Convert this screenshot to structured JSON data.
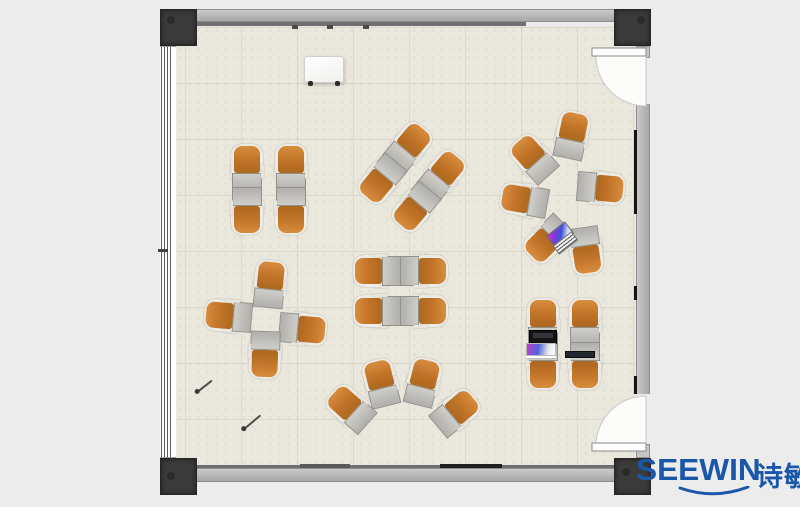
{
  "scene_title": "Classroom floor plan with desk-chair clusters",
  "logo": {
    "brand": "SEEWIN",
    "chinese": "诗敏",
    "color": "#1b57a8"
  },
  "colors": {
    "background": "#ececec",
    "floor": "#eae7dd",
    "floor_grid": "#dcd8cb",
    "wall": "#b5b5b5",
    "wall_dark_line": "#6f6f6f",
    "corner_post": "#3b3b3b",
    "chair_orange": "#c07327",
    "chair_frame": "#ecebe5",
    "desk_gray": "#b8b7b3",
    "door_swing": "#fcfcfa"
  },
  "plan": {
    "units": [
      {
        "x": 247,
        "y": 168,
        "r": 0
      },
      {
        "x": 291,
        "y": 168,
        "r": 0
      },
      {
        "x": 247,
        "y": 211,
        "r": 180
      },
      {
        "x": 291,
        "y": 211,
        "r": 180
      },
      {
        "x": 409,
        "y": 146,
        "r": 40
      },
      {
        "x": 443,
        "y": 174,
        "r": 40
      },
      {
        "x": 381,
        "y": 180,
        "r": 220
      },
      {
        "x": 415,
        "y": 208,
        "r": 220
      },
      {
        "x": 572,
        "y": 135,
        "r": 12
      },
      {
        "x": 533,
        "y": 158,
        "r": -42
      },
      {
        "x": 524,
        "y": 200,
        "r": -80
      },
      {
        "x": 601,
        "y": 188,
        "r": 95
      },
      {
        "x": 547,
        "y": 240,
        "r": -135
      },
      {
        "x": 586,
        "y": 251,
        "r": 172
      },
      {
        "x": 377,
        "y": 271,
        "r": -90
      },
      {
        "x": 377,
        "y": 311,
        "r": -90
      },
      {
        "x": 424,
        "y": 271,
        "r": 90
      },
      {
        "x": 424,
        "y": 311,
        "r": 90
      },
      {
        "x": 270,
        "y": 284,
        "r": 6
      },
      {
        "x": 228,
        "y": 316,
        "r": -85
      },
      {
        "x": 303,
        "y": 329,
        "r": 95
      },
      {
        "x": 265,
        "y": 355,
        "r": 182
      },
      {
        "x": 350,
        "y": 408,
        "r": -48
      },
      {
        "x": 381,
        "y": 383,
        "r": -14
      },
      {
        "x": 423,
        "y": 382,
        "r": 14
      },
      {
        "x": 456,
        "y": 412,
        "r": 50
      },
      {
        "x": 543,
        "y": 322,
        "r": 0
      },
      {
        "x": 585,
        "y": 322,
        "r": 0
      },
      {
        "x": 543,
        "y": 366,
        "r": 180
      },
      {
        "x": 585,
        "y": 366,
        "r": 180
      }
    ],
    "rects": [
      {
        "name": "top-wall",
        "cls": "wall-h",
        "x": 196,
        "y": 9,
        "w": 419,
        "h": 13
      },
      {
        "name": "top-wall-dark-line",
        "x": 196,
        "y": 22,
        "w": 330,
        "h": 4,
        "bg": "#6f6f6f"
      },
      {
        "name": "top-wall-tick",
        "x": 292,
        "y": 25,
        "w": 6,
        "h": 4,
        "bg": "#4a4a4a"
      },
      {
        "name": "top-wall-tick",
        "x": 327,
        "y": 25,
        "w": 6,
        "h": 4,
        "bg": "#4a4a4a"
      },
      {
        "name": "top-wall-tick",
        "x": 363,
        "y": 25,
        "w": 6,
        "h": 4,
        "bg": "#4a4a4a"
      },
      {
        "name": "bottom-wall-dark-line",
        "x": 196,
        "y": 465,
        "w": 419,
        "h": 3,
        "bg": "#6f6f6f"
      },
      {
        "name": "bottom-wall",
        "cls": "wall-h",
        "x": 196,
        "y": 468,
        "w": 419,
        "h": 14
      },
      {
        "name": "bottom-wall-segment",
        "x": 440,
        "y": 464,
        "w": 62,
        "h": 4,
        "bg": "#1f1f1f"
      },
      {
        "name": "bottom-wall-segment",
        "x": 300,
        "y": 464,
        "w": 50,
        "h": 4,
        "bg": "#595959"
      },
      {
        "name": "left-window-wall",
        "cls": "window-v",
        "x": 160,
        "y": 46,
        "w": 16,
        "h": 412
      },
      {
        "name": "left-window-tick",
        "x": 158,
        "y": 249,
        "w": 10,
        "h": 3,
        "bg": "#444444"
      },
      {
        "name": "right-wall",
        "cls": "wall-v",
        "x": 636,
        "y": 104,
        "w": 14,
        "h": 290
      },
      {
        "name": "right-wall-segment",
        "x": 634,
        "y": 130,
        "w": 3,
        "h": 84,
        "bg": "#141414"
      },
      {
        "name": "right-wall-segment",
        "x": 634,
        "y": 286,
        "w": 3,
        "h": 14,
        "bg": "#141414"
      },
      {
        "name": "right-wall-segment",
        "x": 634,
        "y": 376,
        "w": 3,
        "h": 18,
        "bg": "#141414"
      },
      {
        "name": "door-jamb",
        "cls": "door-jamb",
        "x": 636,
        "y": 46,
        "w": 14,
        "h": 12
      },
      {
        "name": "door-jamb",
        "cls": "door-jamb",
        "x": 636,
        "y": 444,
        "w": 14,
        "h": 14
      },
      {
        "name": "corner-post",
        "cls": "post",
        "x": 160,
        "y": 9,
        "w": 37,
        "h": 37
      },
      {
        "name": "corner-post",
        "cls": "post",
        "x": 614,
        "y": 9,
        "w": 37,
        "h": 37
      },
      {
        "name": "corner-post",
        "cls": "post",
        "x": 160,
        "y": 458,
        "w": 37,
        "h": 37
      },
      {
        "name": "corner-post",
        "cls": "post",
        "x": 614,
        "y": 458,
        "w": 37,
        "h": 37
      },
      {
        "name": "post-dot",
        "cls": "post-dot",
        "x": 167,
        "y": 16,
        "w": 8,
        "h": 8
      },
      {
        "name": "post-dot",
        "cls": "post-dot",
        "x": 637,
        "y": 16,
        "w": 8,
        "h": 8
      },
      {
        "name": "post-dot",
        "cls": "post-dot",
        "x": 167,
        "y": 472,
        "w": 8,
        "h": 8
      },
      {
        "name": "post-dot",
        "cls": "post-dot",
        "x": 622,
        "y": 468,
        "w": 8,
        "h": 8
      },
      {
        "name": "whiteboard",
        "cls": "whiteboard",
        "x": 304,
        "y": 56,
        "w": 40,
        "h": 27
      },
      {
        "name": "whiteboard-foot",
        "cls": "wb-foot",
        "x": 308,
        "y": 81,
        "w": 5,
        "h": 5
      },
      {
        "name": "whiteboard-foot",
        "cls": "wb-foot",
        "x": 335,
        "y": 81,
        "w": 5,
        "h": 5
      },
      {
        "name": "pen",
        "cls": "pen",
        "x": 196,
        "y": 385,
        "w": 18,
        "h": 2,
        "r": -38
      },
      {
        "name": "pen",
        "cls": "pen",
        "x": 242,
        "y": 421,
        "w": 21,
        "h": 2,
        "r": -40
      },
      {
        "name": "laptop-open",
        "cls": "obj-laptop-open",
        "x": 548,
        "y": 227,
        "w": 24,
        "h": 15,
        "r": -38
      },
      {
        "name": "laptop-closed",
        "cls": "obj-laptop-flat",
        "x": 529,
        "y": 330,
        "w": 28,
        "h": 14
      },
      {
        "name": "paper-stack",
        "cls": "obj-papers",
        "x": 526,
        "y": 343,
        "w": 30,
        "h": 13
      },
      {
        "name": "tablet",
        "cls": "obj-tablet",
        "x": 565,
        "y": 351,
        "w": 30,
        "h": 7
      }
    ]
  }
}
